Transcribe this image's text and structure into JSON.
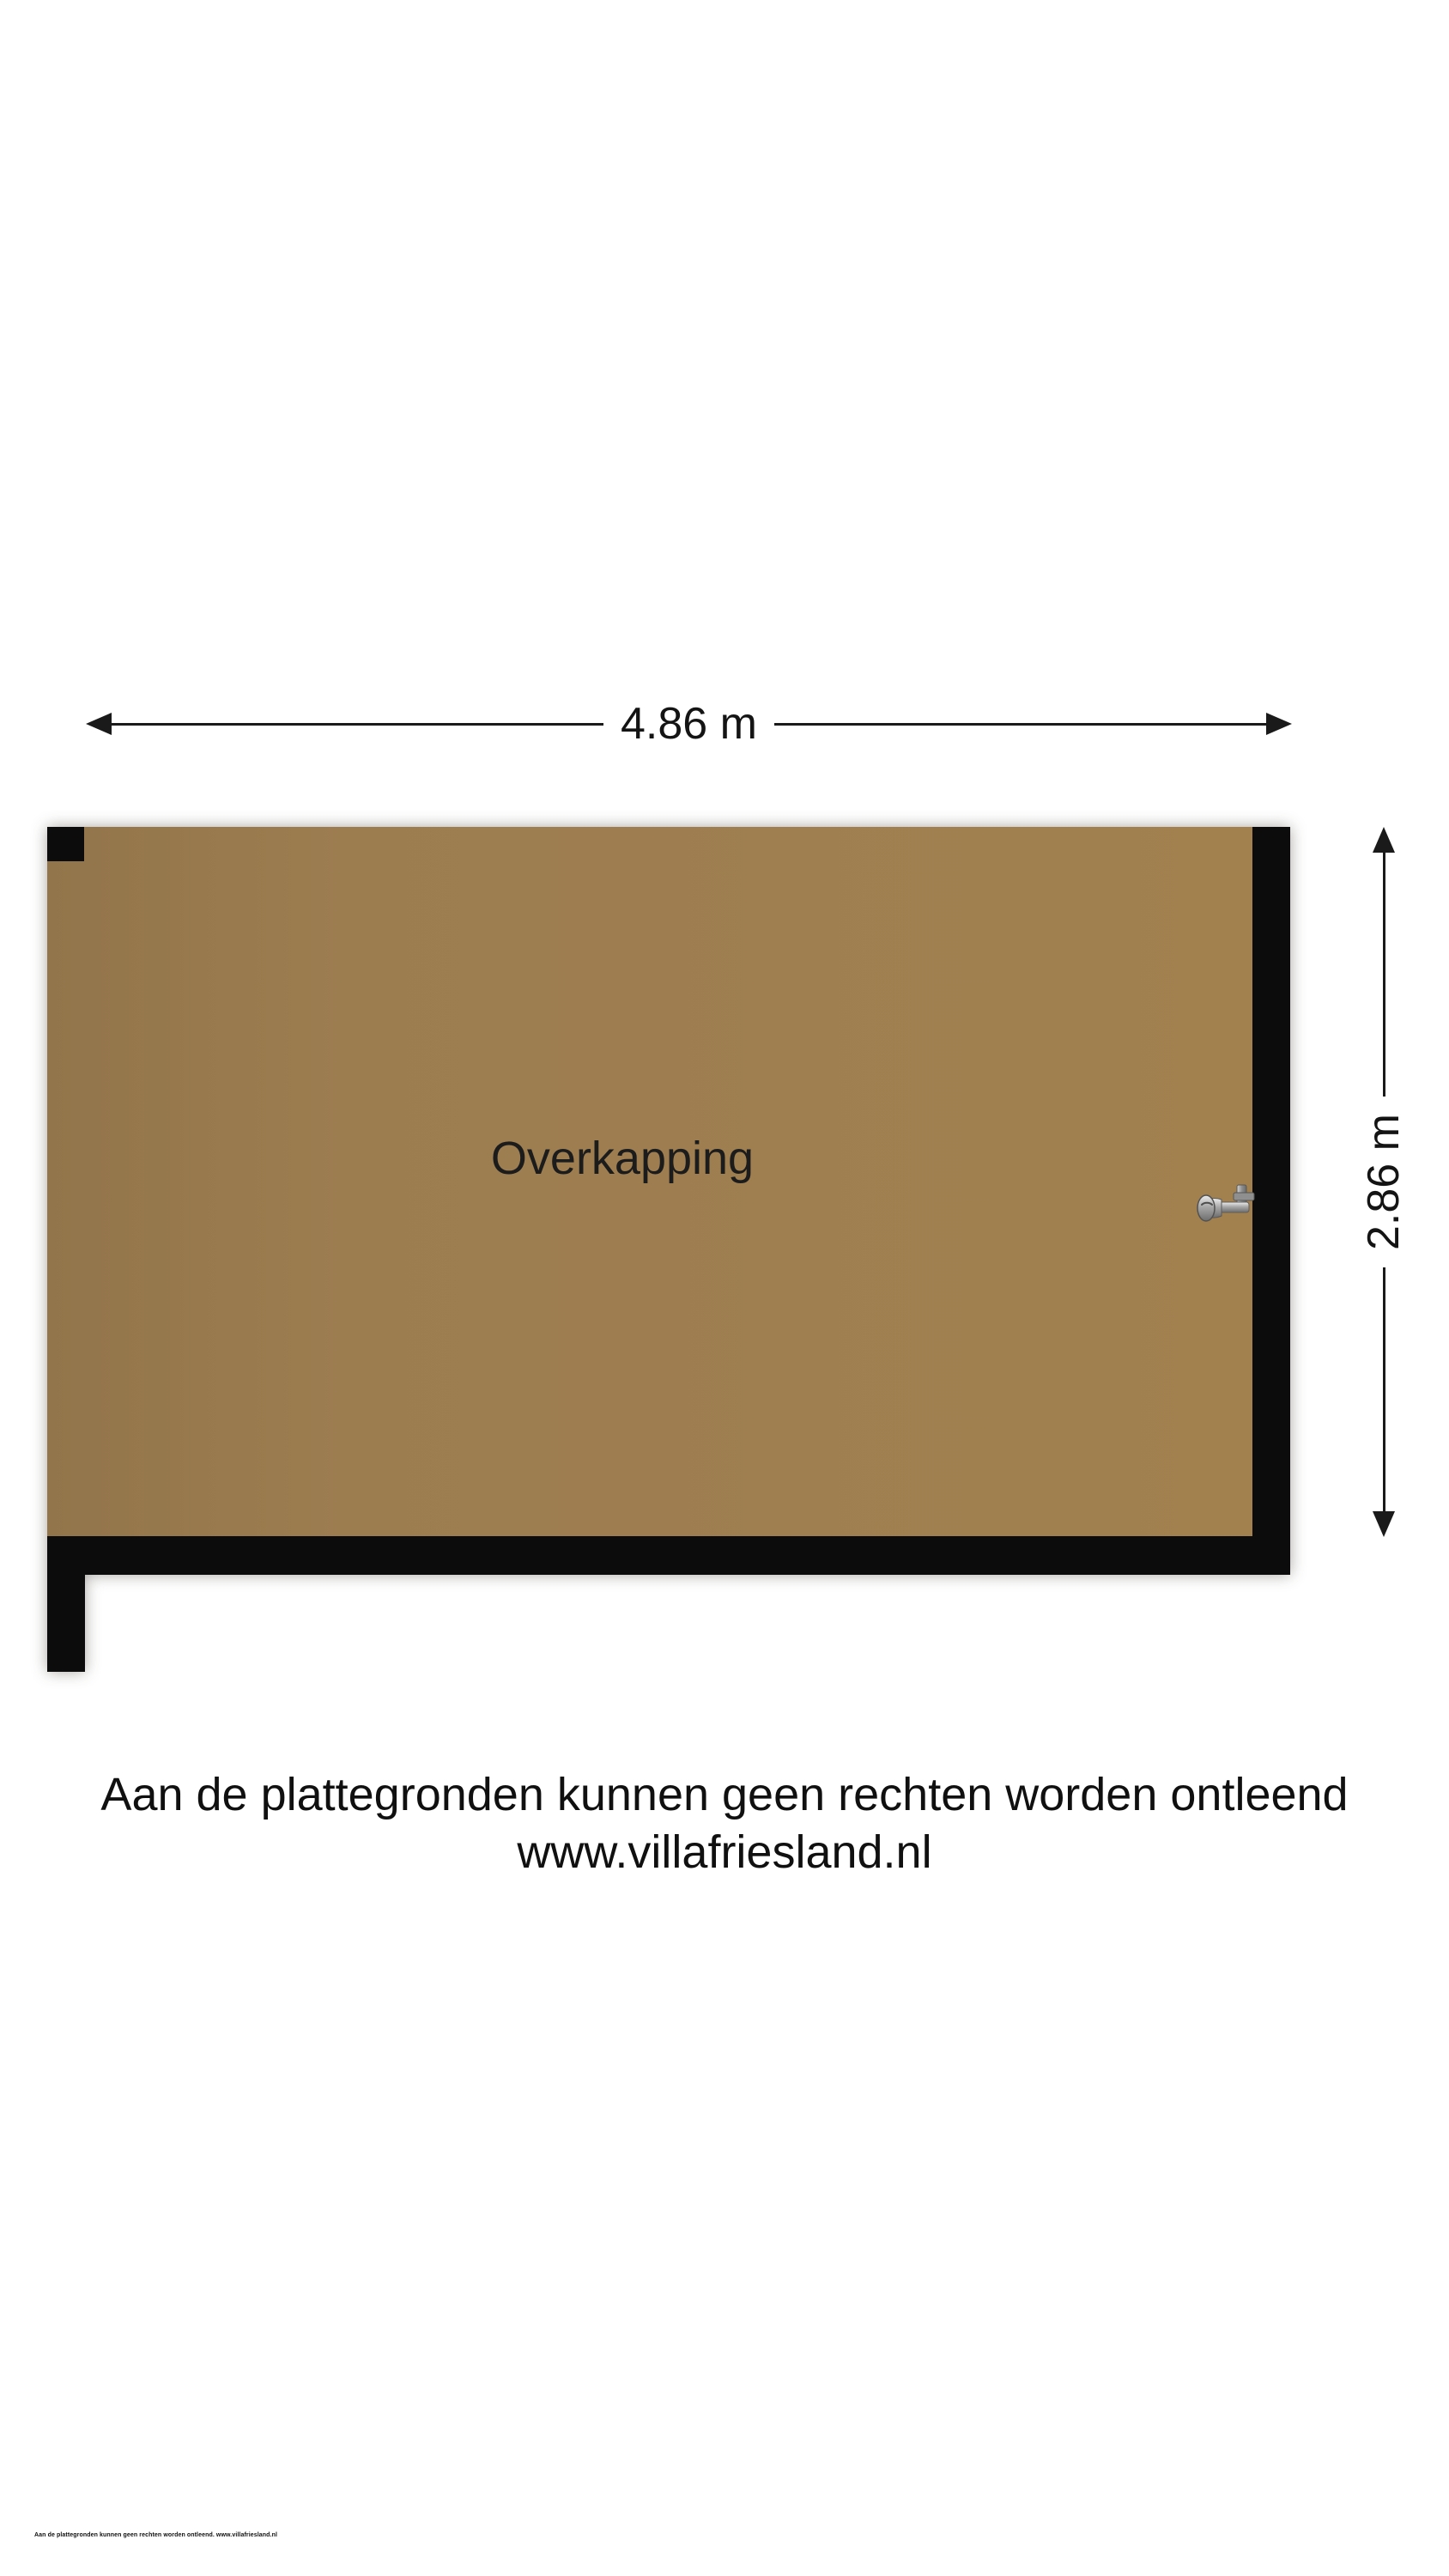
{
  "theme": {
    "background": "#ffffff",
    "floor_color": "#9c7d50",
    "wall_color": "#0c0c0c",
    "dim_color": "#1a1a1a",
    "text_color": "#141414"
  },
  "floorplan": {
    "room_label": "Overkapping",
    "width_label": "4.86 m",
    "height_label": "2.86 m",
    "fixtures": [
      "water-tap"
    ]
  },
  "footer": {
    "disclaimer_line1": "Aan de plattegronden kunnen geen rechten worden ontleend",
    "website": "www.villafriesland.nl",
    "fine_print": "Aan de plattegronden kunnen geen rechten worden ontleend. www.villafriesland.nl"
  }
}
